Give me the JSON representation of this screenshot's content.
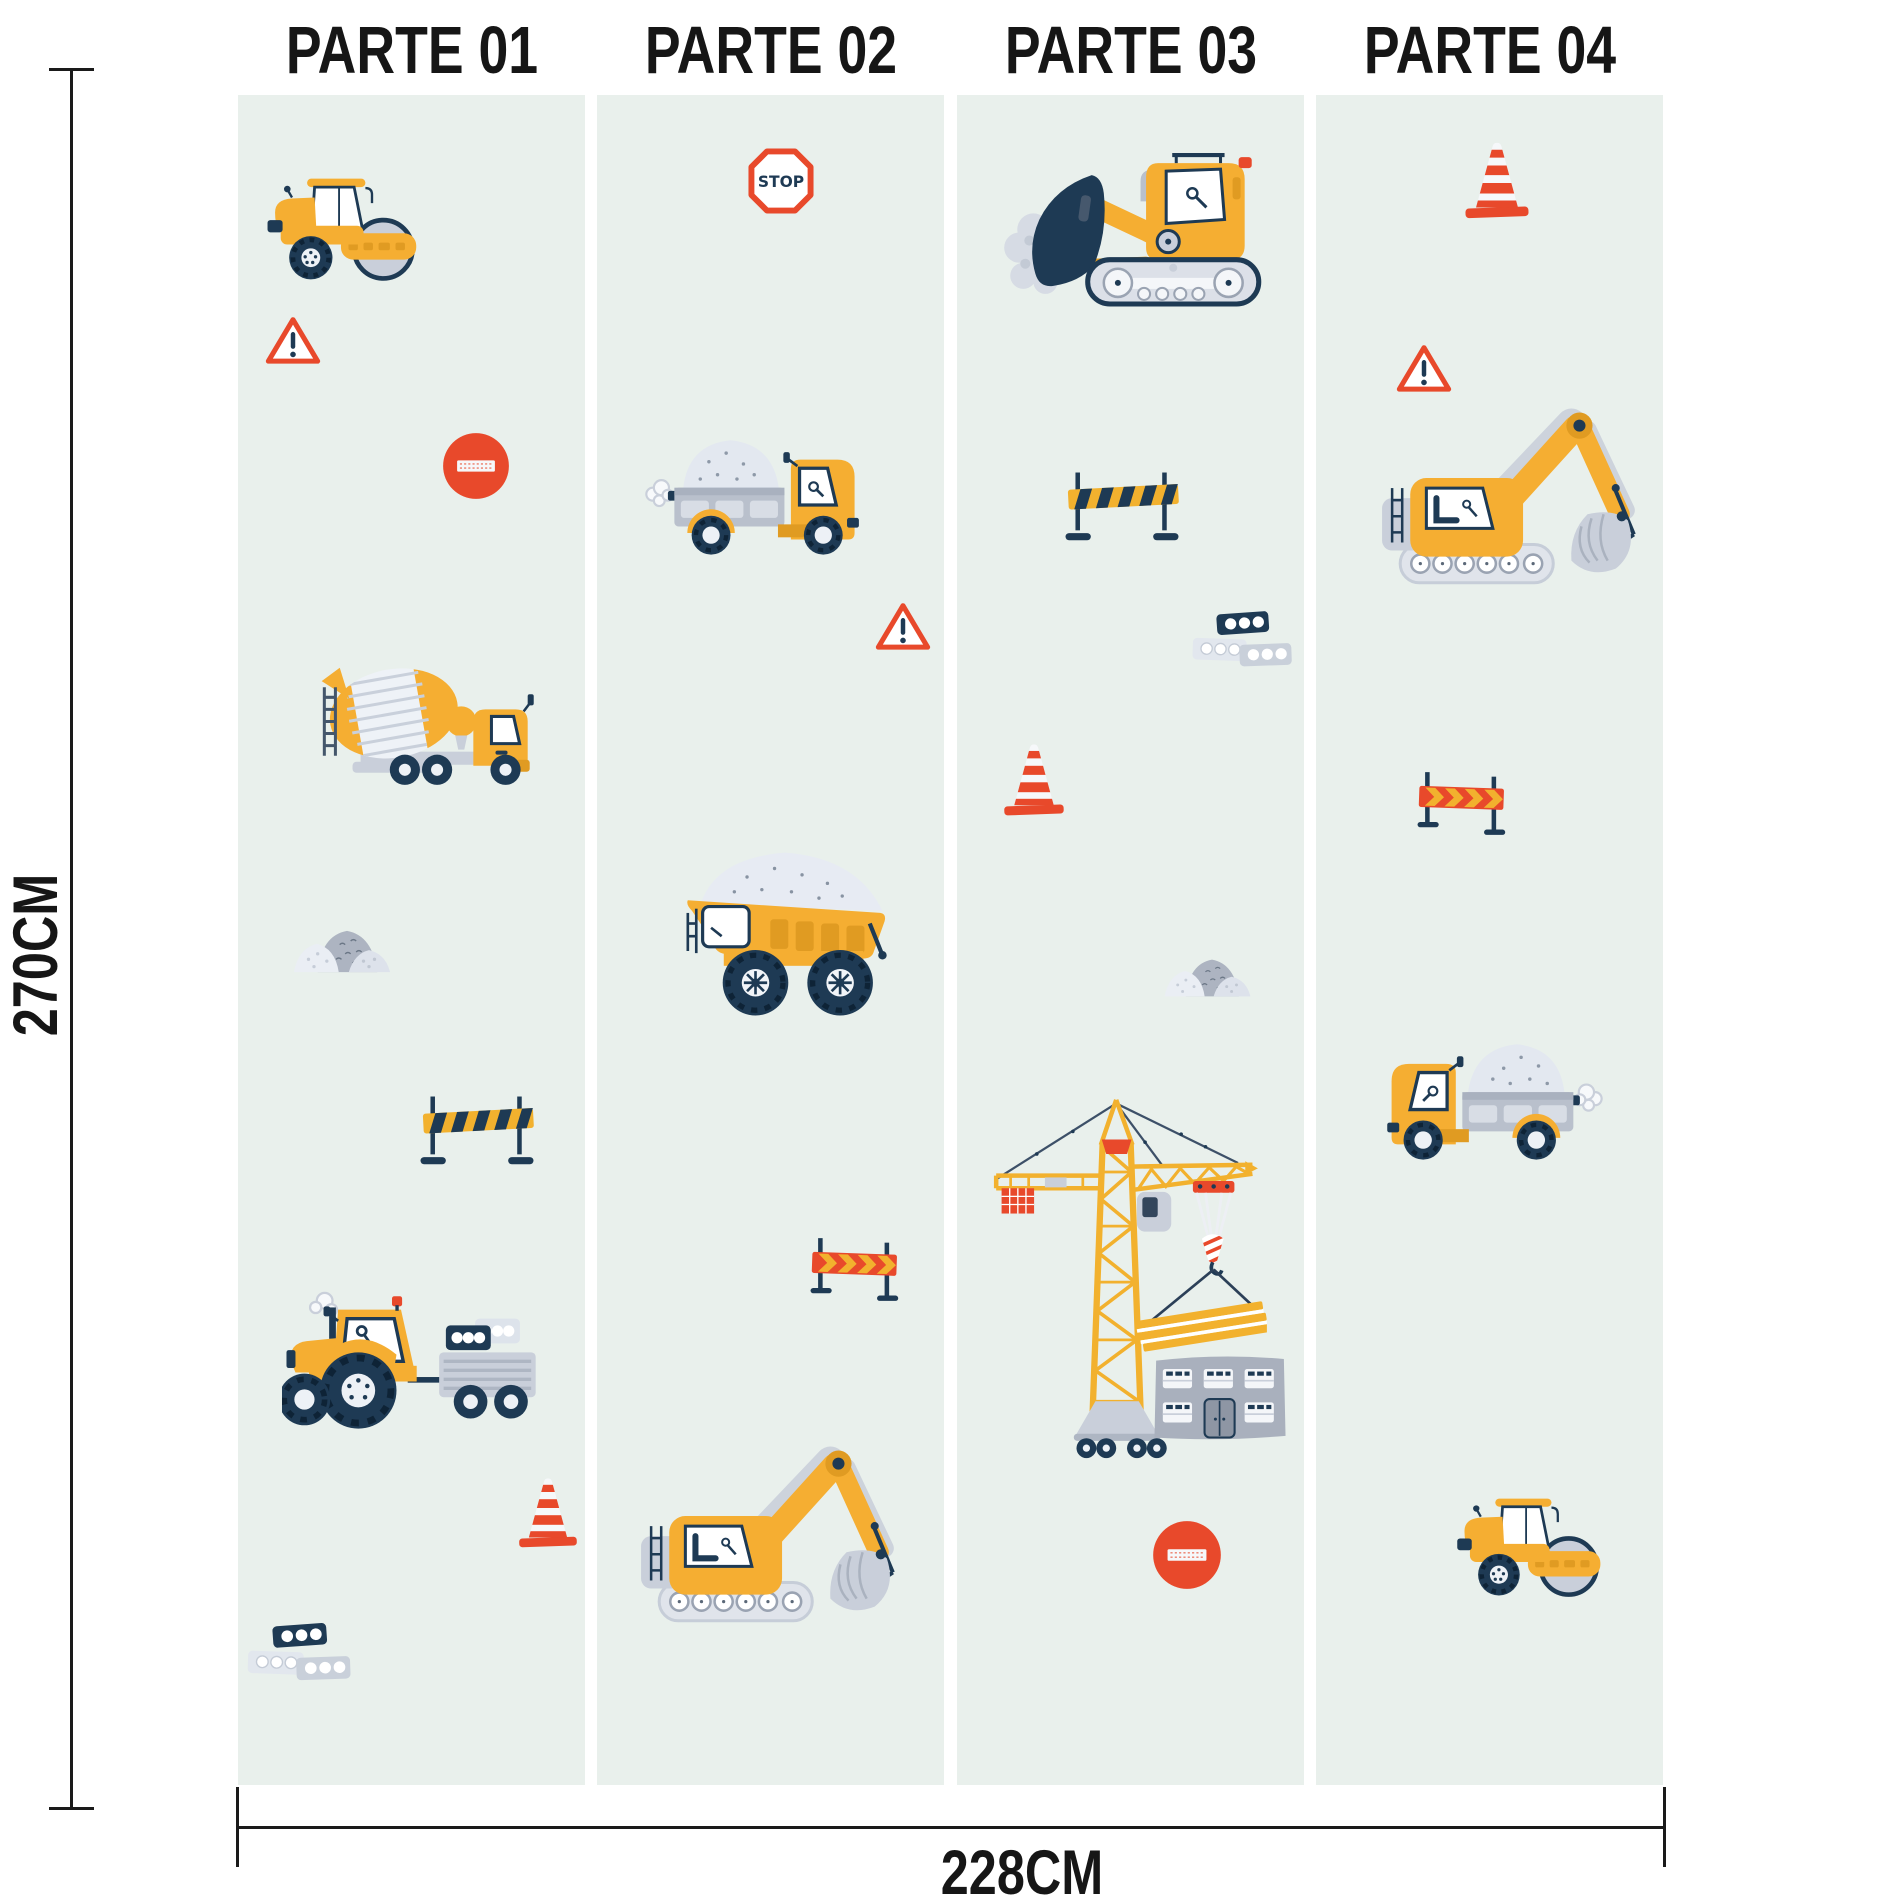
{
  "dimensions": {
    "height_label": "270CM",
    "width_label": "228CM"
  },
  "signs": {
    "stop_text": "STOP"
  },
  "palette": {
    "panel_bg": "#E9F0EC",
    "vehicle_yellow": "#F5AE32",
    "accent_gold": "#E09B22",
    "sign_red": "#E8492B",
    "navy": "#1E3A54",
    "gray": "#C9CFDA",
    "light_gray": "#E3E8F0",
    "line_black": "#1a1a1a"
  },
  "panels": [
    {
      "label": "PARTE 01",
      "x": 238,
      "y": 95,
      "w": 347,
      "h": 1690,
      "items": [
        {
          "icon": "roller",
          "x": 22,
          "y": 78,
          "w": 160,
          "h": 113
        },
        {
          "icon": "warning",
          "x": 27,
          "y": 220,
          "w": 56,
          "h": 52
        },
        {
          "icon": "noentry",
          "x": 203,
          "y": 336,
          "w": 70,
          "h": 70
        },
        {
          "icon": "mixer",
          "x": 70,
          "y": 556,
          "w": 232,
          "h": 151
        },
        {
          "icon": "gravel",
          "x": 54,
          "y": 824,
          "w": 110,
          "h": 55
        },
        {
          "icon": "barrier_yellow",
          "x": 178,
          "y": 996,
          "w": 122,
          "h": 77
        },
        {
          "icon": "tractor",
          "x": 44,
          "y": 1192,
          "w": 275,
          "h": 152
        },
        {
          "icon": "cone",
          "x": 278,
          "y": 1380,
          "w": 64,
          "h": 74
        },
        {
          "icon": "blocks",
          "x": 8,
          "y": 1526,
          "w": 108,
          "h": 70
        }
      ]
    },
    {
      "label": "PARTE 02",
      "x": 597,
      "y": 95,
      "w": 347,
      "h": 1690,
      "items": [
        {
          "icon": "stop",
          "x": 150,
          "y": 52,
          "w": 68,
          "h": 68
        },
        {
          "icon": "truck",
          "x": 45,
          "y": 332,
          "w": 232,
          "h": 130
        },
        {
          "icon": "warning",
          "x": 278,
          "y": 506,
          "w": 56,
          "h": 52
        },
        {
          "icon": "dump",
          "x": 76,
          "y": 750,
          "w": 238,
          "h": 175
        },
        {
          "icon": "barrier_orange",
          "x": 206,
          "y": 1140,
          "w": 102,
          "h": 72
        },
        {
          "icon": "excavator",
          "x": 36,
          "y": 1308,
          "w": 282,
          "h": 222
        }
      ]
    },
    {
      "label": "PARTE 03",
      "x": 957,
      "y": 95,
      "w": 347,
      "h": 1690,
      "items": [
        {
          "icon": "dozer",
          "x": 38,
          "y": 52,
          "w": 282,
          "h": 161
        },
        {
          "icon": "barrier_yellow",
          "x": 104,
          "y": 372,
          "w": 122,
          "h": 77
        },
        {
          "icon": "blocks",
          "x": 234,
          "y": 514,
          "w": 104,
          "h": 68
        },
        {
          "icon": "cone",
          "x": 44,
          "y": 646,
          "w": 66,
          "h": 76
        },
        {
          "icon": "gravel",
          "x": 206,
          "y": 854,
          "w": 98,
          "h": 49
        },
        {
          "icon": "crane",
          "x": 12,
          "y": 994,
          "w": 298,
          "h": 379
        },
        {
          "icon": "building",
          "x": 194,
          "y": 1254,
          "w": 138,
          "h": 96
        },
        {
          "icon": "noentry",
          "x": 194,
          "y": 1424,
          "w": 72,
          "h": 72
        }
      ]
    },
    {
      "label": "PARTE 04",
      "x": 1316,
      "y": 95,
      "w": 347,
      "h": 1690,
      "items": [
        {
          "icon": "cone",
          "x": 146,
          "y": 44,
          "w": 70,
          "h": 81
        },
        {
          "icon": "warning",
          "x": 80,
          "y": 248,
          "w": 56,
          "h": 52
        },
        {
          "icon": "excavator",
          "x": 58,
          "y": 270,
          "w": 282,
          "h": 222
        },
        {
          "icon": "barrier_orange",
          "x": 94,
          "y": 674,
          "w": 102,
          "h": 72
        },
        {
          "icon": "truck",
          "x": 56,
          "y": 936,
          "w": 234,
          "h": 131,
          "flip": true
        },
        {
          "icon": "roller",
          "x": 134,
          "y": 1398,
          "w": 154,
          "h": 109
        }
      ]
    }
  ]
}
